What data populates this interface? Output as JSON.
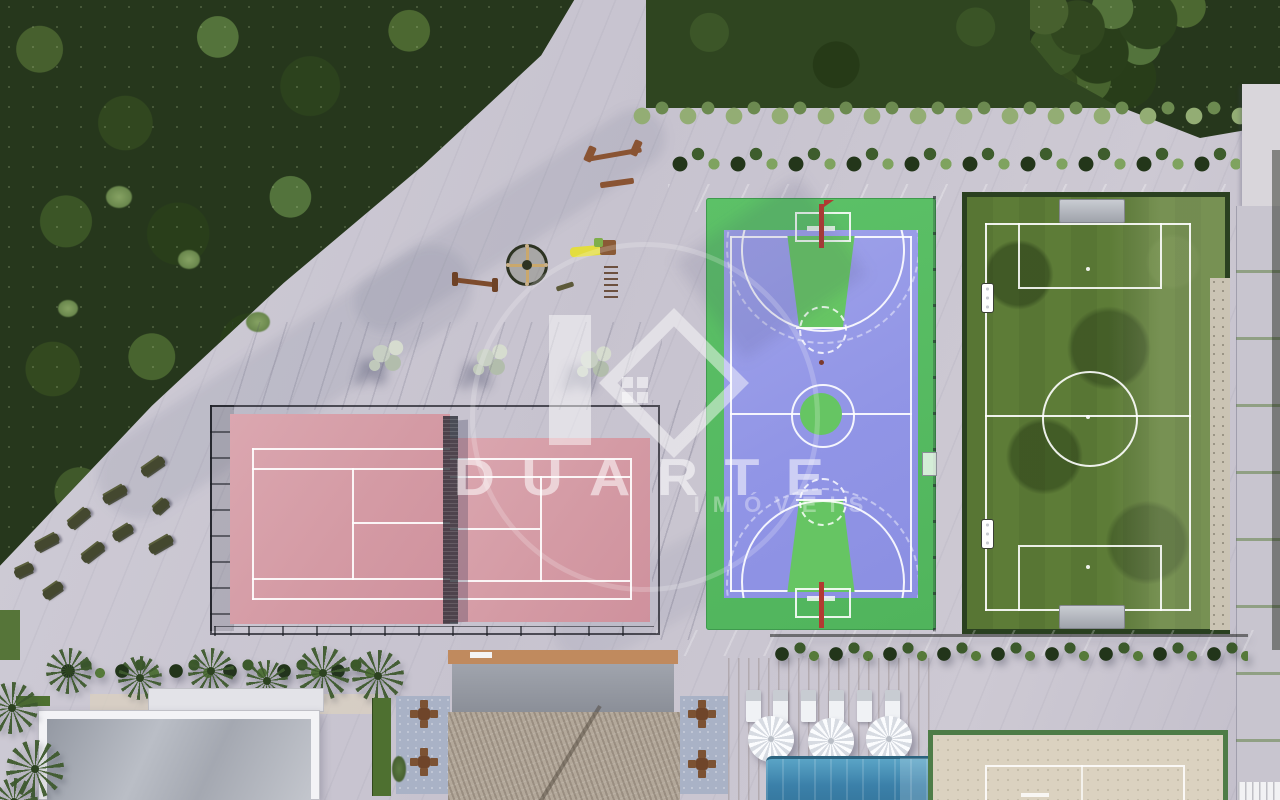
{
  "watermark": {
    "brand": "DUARTE",
    "tagline": "IMÓVEIS"
  },
  "scene": {
    "type": "aerial-3d-render",
    "subject": "condominium sports and leisure masterplan, top-down view",
    "facilities": [
      {
        "id": "preserved-forest",
        "position": "top-left"
      },
      {
        "id": "playground",
        "position": "upper-center"
      },
      {
        "id": "outdoor-gym",
        "position": "left"
      },
      {
        "id": "tennis-court",
        "surface_color": "#d49aa4",
        "line_color": "#ffffff"
      },
      {
        "id": "multisport-court",
        "surface_color": "#9195e6",
        "border_color": "#57bd62",
        "key_color": "#66c563"
      },
      {
        "id": "soccer-field",
        "surface_color": "#5d7c37",
        "line_color": "#ffffff"
      },
      {
        "id": "swimming-pool",
        "water_color": "#3b80a9"
      },
      {
        "id": "wood-deck-with-loungers-and-umbrellas"
      },
      {
        "id": "beach-tennis-court",
        "sand_color": "#dbd2c0",
        "border_color": "#4e7c47"
      },
      {
        "id": "kiosk-thatched-roof"
      },
      {
        "id": "clubhouse-flat-roof"
      },
      {
        "id": "palm-trees-and-hedges"
      }
    ],
    "colors": {
      "pavement": "#c9c5d1",
      "forest_dark": "#26371c",
      "lawn": "#2f4520",
      "tennis_pink": "#d49aa4",
      "court_blue": "#9195e6",
      "court_green": "#57bd62",
      "grass_field": "#5d7c37",
      "pool_blue": "#3b80a9",
      "deck_wood": "#b98a63",
      "sand": "#dbd2c0",
      "watermark_white": "#ffffff"
    }
  }
}
